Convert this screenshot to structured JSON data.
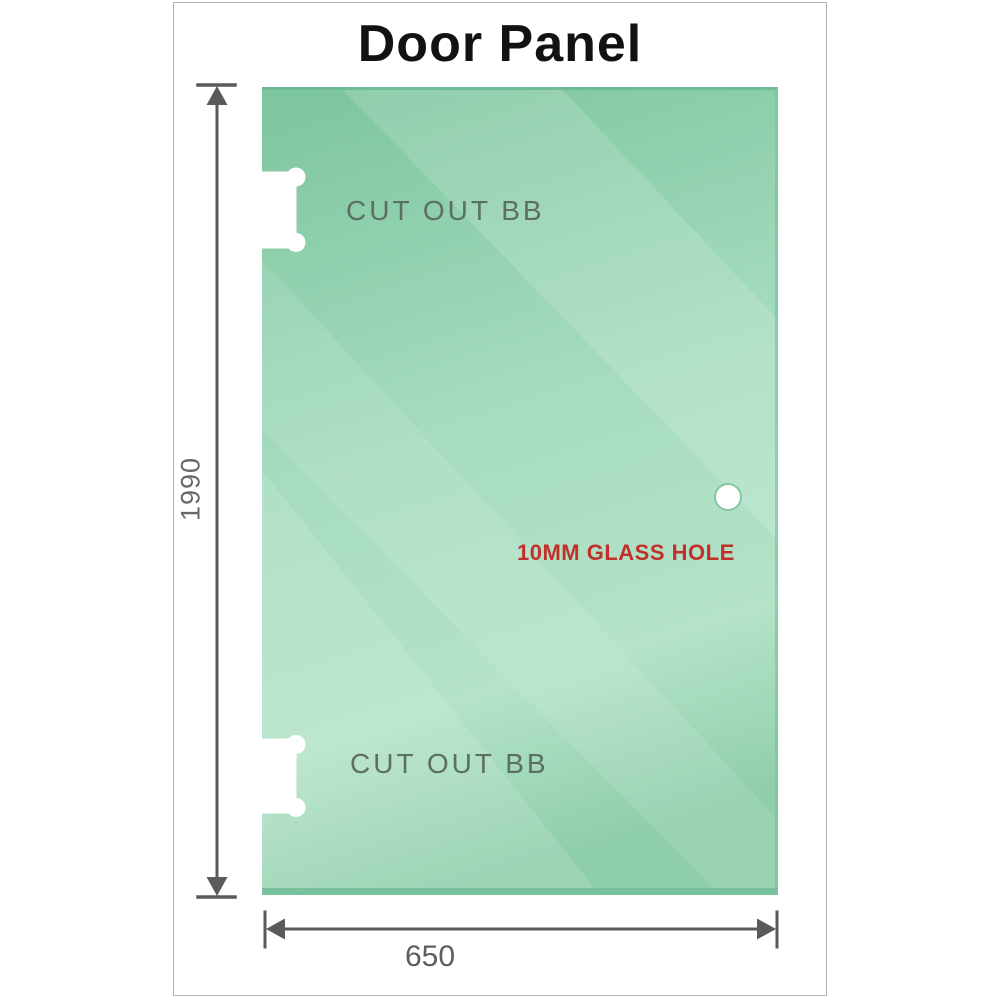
{
  "title": "Door Panel",
  "dimensions": {
    "height_label": "1990",
    "width_label": "650"
  },
  "panel": {
    "top_cutout_label": "CUT OUT BB",
    "bottom_cutout_label": "CUT OUT BB",
    "glass_hole_label": "10MM GLASS HOLE"
  },
  "colors": {
    "glass_base": "#7ec69e",
    "glass_mid": "#a6dcc0",
    "glass_light": "#b7e4c9",
    "glass_bottom": "#8fceaa",
    "glass_edge_dark": "#6fbd95",
    "hole_ring": "#83c7a3",
    "dimension_gray": "#5a5a5a",
    "cutout_label_gray": "#5c6f64",
    "hole_label_red": "#c1302a",
    "frame_border": "#b3b3b3",
    "title_color": "#121212"
  }
}
